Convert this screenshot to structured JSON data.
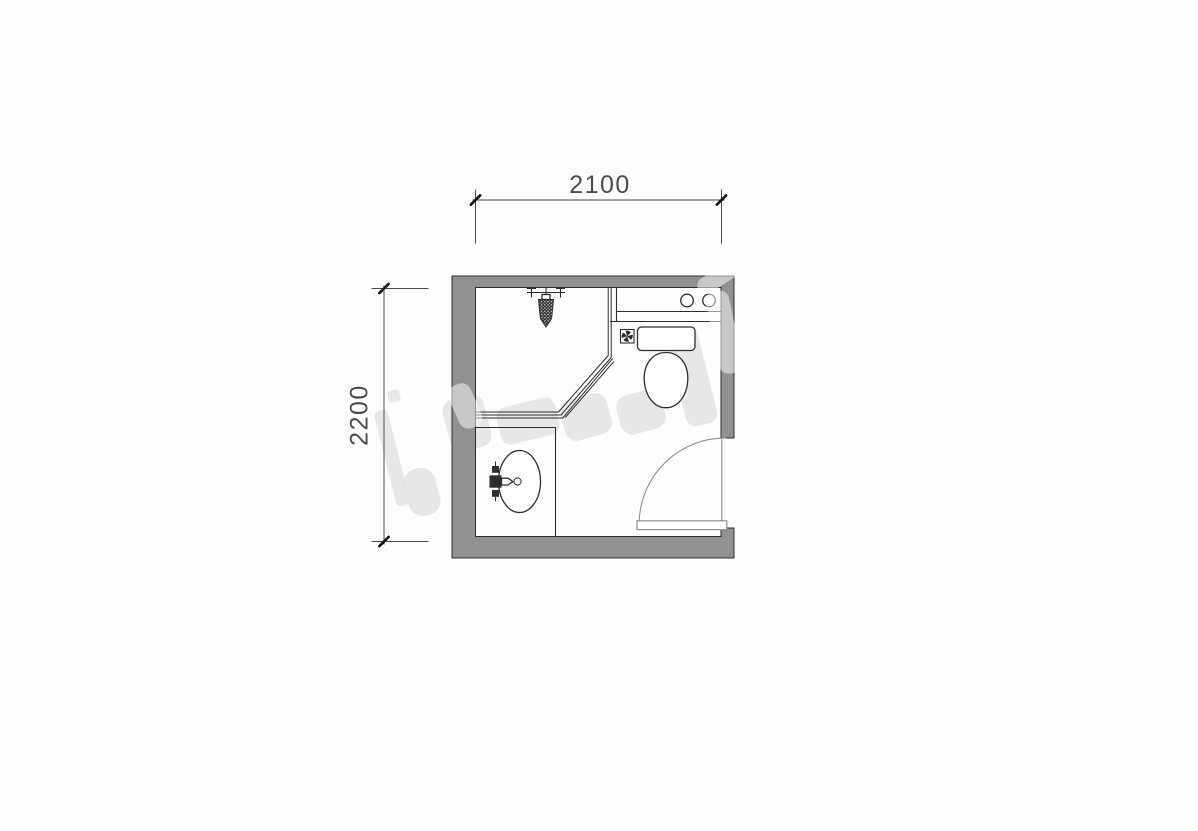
{
  "drawing": {
    "kind": "bathroom floor plan"
  },
  "dimensions": {
    "width": {
      "label": "2100",
      "orientation": "horizontal"
    },
    "height": {
      "label": "2200",
      "orientation": "vertical"
    }
  },
  "fixtures": {
    "shower_fixture": "shower-mixer-icon",
    "shower_enclosure": "corner-glass-panel",
    "counter": "counter-with-two-knobs",
    "floor_drain": "floor-drain-pinwheel-icon",
    "toilet": "toilet-tank-and-bowl",
    "washbasin": "oval-basin-with-faucet",
    "door": "swing-door-quarter-arc"
  },
  "colors": {
    "background": "#fdfdfd",
    "wall_fill": "#919191",
    "line": "#2d2d2d",
    "door_line": "#8e8e8e",
    "dim_line": "#4c4c4c",
    "tick": "#141414",
    "watermark": "#e3e3e3"
  }
}
